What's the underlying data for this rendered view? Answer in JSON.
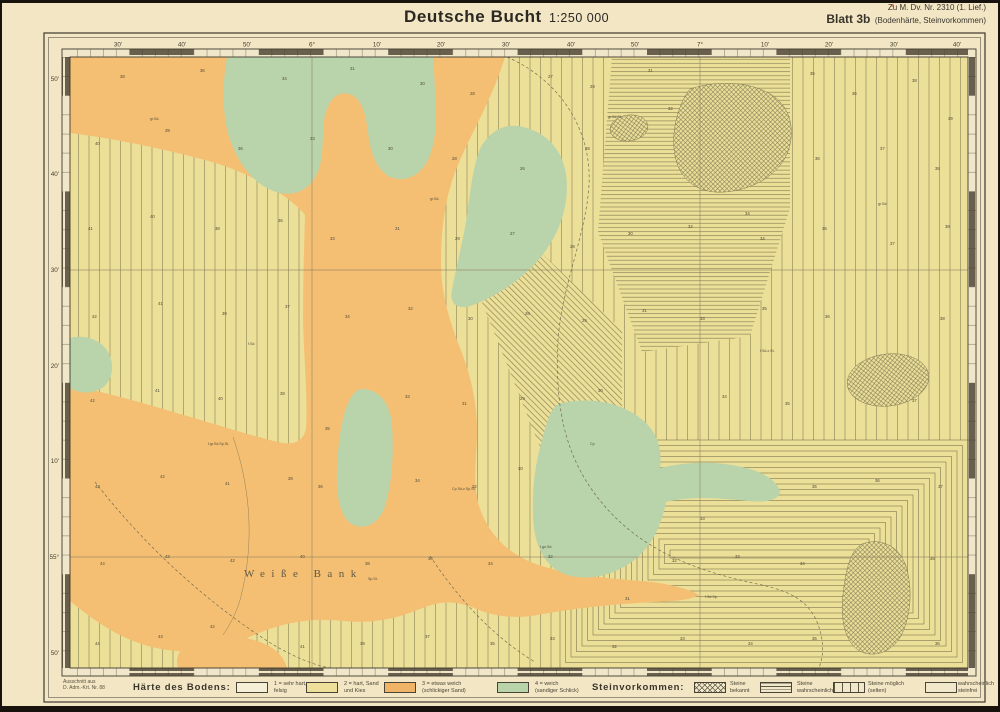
{
  "header": {
    "title": "Deutsche Bucht",
    "scale": "1:250 000",
    "ref_top": "Zu M. Dv. Nr. 2310 (1. Lief.)",
    "sheet": "Blatt 3b",
    "sheet_sub": "(Bodenhärte, Steinvorkommen)"
  },
  "colors": {
    "paper": "#f2e6c5",
    "map_yellow": "#ecdf97",
    "orange": "#f4bf73",
    "green": "#b9d3ab",
    "hatch": "#6e6747",
    "frame": "#3f3a2e",
    "ink": "#2b2822"
  },
  "legend": {
    "source_note_line1": "Ausschnitt aus",
    "source_note_line2": "D. Adm.-Krt. Nr. 88",
    "hardness_title": "Härte des Bodens:",
    "hardness_items": [
      {
        "line1": "1 = sehr hart,",
        "line2": "felsig",
        "swatch": "white"
      },
      {
        "line1": "2 = hart, Sand",
        "line2": "und Kies",
        "swatch": "yellow"
      },
      {
        "line1": "3 = etwas weich",
        "line2": "(schlickiger Sand)",
        "swatch": "orange"
      },
      {
        "line1": "4 = weich",
        "line2": "(sandiger Schlick)",
        "swatch": "green"
      }
    ],
    "stones_title": "Steinvorkommen:",
    "stones_items": [
      {
        "line1": "Steine",
        "line2": "bekannt",
        "swatch": "cross"
      },
      {
        "line1": "Steine",
        "line2": "wahrscheinlich",
        "swatch": "hlines"
      },
      {
        "line1": "Steine möglich",
        "line2": "(selten)",
        "swatch": "vlines"
      },
      {
        "line1": "wahrscheinlich",
        "line2": "steinfrei",
        "swatch": "plain"
      }
    ]
  },
  "map": {
    "sea_label": {
      "text": "Weiße Bank",
      "x": 244,
      "y": 577
    },
    "lon_labels": [
      [
        118,
        "30'"
      ],
      [
        182,
        "40'"
      ],
      [
        247,
        "50'"
      ],
      [
        312,
        "6°"
      ],
      [
        377,
        "10'"
      ],
      [
        441,
        "20'"
      ],
      [
        506,
        "30'"
      ],
      [
        571,
        "40'"
      ],
      [
        635,
        "50'"
      ],
      [
        700,
        "7°"
      ],
      [
        765,
        "10'"
      ],
      [
        829,
        "20'"
      ],
      [
        894,
        "30'"
      ],
      [
        957,
        "40'"
      ]
    ],
    "lat_labels": [
      [
        79,
        "50'"
      ],
      [
        174,
        "40'"
      ],
      [
        270,
        "30'"
      ],
      [
        366,
        "20'"
      ],
      [
        461,
        "10'"
      ],
      [
        557,
        "55°"
      ],
      [
        653,
        "50'"
      ]
    ],
    "graticule": {
      "v": [
        312,
        700
      ],
      "h": [
        270,
        557
      ]
    },
    "zones": [
      {
        "kind": "vlines",
        "rect": [
          70,
          57,
          545,
          611
        ]
      },
      {
        "kind": "vlines",
        "rect": [
          615,
          57,
          353,
          388
        ]
      },
      {
        "kind": "hlines",
        "path": "M612,57 L790,57 L790,208 L750,336 L642,352 L598,232 Z"
      },
      {
        "kind": "diag",
        "path": "M482,196 L622,330 L622,448 L546,462 L482,302 Z"
      },
      {
        "kind": "rings",
        "rect": [
          560,
          440,
          408,
          228
        ],
        "inset": 5.5
      }
    ],
    "soil_regions": [
      {
        "fill": "orange",
        "d": "M70,57 L505,57 C492,100 470,135 458,165 C445,195 441,230 441,262 C441,295 450,322 460,348 C472,378 477,405 477,432 C477,458 472,480 479,506 C488,534 508,553 533,563 C562,574 602,578 641,581 C668,583 689,589 699,595 C688,601 672,601 655,602 C615,604 575,608 543,614 C515,620 492,616 474,608 C452,599 438,602 420,609 C396,619 370,624 344,621 C316,618 290,621 264,631 C243,640 218,649 194,651 C168,653 140,646 116,633 C98,623 82,611 70,601 L70,385 C100,391 140,402 180,414 C215,424 252,436 278,442 C294,446 304,441 306,428 C308,400 304,360 303,320 C303,285 304,250 305,215 C290,196 250,172 205,160 C160,148 110,138 70,133 Z"
      },
      {
        "fill": "orange",
        "d": "M178,668 C174,656 182,644 198,639 C221,633 249,636 267,645 C279,651 285,660 287,668 Z"
      },
      {
        "fill": "green",
        "d": "M227,57 L433,57 C434,70 435,85 435,98 C437,120 436,143 428,160 C420,176 404,184 388,176 C376,168 370,152 368,132 C366,115 362,100 352,95 C340,90 330,96 325,115 C322,130 324,148 320,165 C315,185 300,197 280,193 C258,188 240,168 230,140 C222,115 222,85 227,57 Z"
      },
      {
        "fill": "green",
        "d": "M518,126 C544,130 562,148 566,174 C570,204 560,234 540,258 C522,279 498,296 470,306 C457,310 449,303 452,290 C456,268 462,245 466,222 C470,195 472,170 480,149 C488,133 502,124 518,126 Z"
      },
      {
        "fill": "green",
        "d": "M70,338 C85,334 101,340 108,352 C115,365 113,380 102,388 C90,395 78,393 70,388 Z"
      },
      {
        "fill": "green",
        "d": "M362,389 C378,389 390,402 392,425 C394,455 392,486 384,509 C377,526 362,531 350,523 C340,515 336,496 337,470 C338,442 342,414 350,399 C354,392 358,389 362,389 Z"
      },
      {
        "fill": "green",
        "d": "M558,404 C588,396 620,402 640,418 C656,430 663,448 660,468 C684,462 716,460 746,468 C766,473 779,483 780,492 C779,500 765,503 748,501 C720,498 690,496 666,502 C662,522 654,542 639,556 C620,573 594,581 571,576 C549,571 537,552 534,528 C531,500 534,468 541,444 C546,424 550,410 558,404 Z"
      }
    ],
    "stone_regions": [
      {
        "d": "M690,89 C720,79 756,82 776,98 C792,111 796,135 786,156 C776,176 752,190 725,192 C700,194 682,182 676,160 C670,138 676,107 690,89 Z"
      },
      {
        "ellipse": [
          629,
          128,
          19,
          13,
          -8
        ]
      },
      {
        "ellipse": [
          888,
          380,
          41,
          26,
          -7
        ]
      },
      {
        "d": "M862,544 C881,537 899,546 906,566 C913,589 911,616 901,636 C891,653 872,659 858,650 C845,641 840,619 843,594 C846,569 850,551 862,544 Z"
      }
    ],
    "dashed_lines": [
      "M507,57 C560,80 592,130 589,185 C586,235 562,285 558,340 C555,400 562,452 598,498 C640,552 700,572 762,585 C792,592 816,602 822,640 C824,653 821,662 819,668",
      "M95,482 C140,540 200,598 272,644 C296,658 316,666 331,668",
      "M430,556 C458,598 492,636 535,662"
    ],
    "contour_lines": [
      "M233,437 C252,492 254,548 240,600 C236,614 229,626 223,635"
    ],
    "soundings": [
      [
        120,
        78,
        "38"
      ],
      [
        200,
        72,
        "36"
      ],
      [
        282,
        80,
        "34"
      ],
      [
        350,
        70,
        "31"
      ],
      [
        420,
        85,
        "30"
      ],
      [
        470,
        95,
        "28"
      ],
      [
        548,
        78,
        "27"
      ],
      [
        590,
        88,
        "29"
      ],
      [
        648,
        72,
        "31"
      ],
      [
        668,
        110,
        "32"
      ],
      [
        810,
        75,
        "35"
      ],
      [
        852,
        95,
        "36"
      ],
      [
        912,
        82,
        "38"
      ],
      [
        948,
        120,
        "39"
      ],
      [
        95,
        145,
        "40"
      ],
      [
        165,
        132,
        "39"
      ],
      [
        238,
        150,
        "36"
      ],
      [
        310,
        140,
        "33"
      ],
      [
        388,
        150,
        "30"
      ],
      [
        452,
        160,
        "28"
      ],
      [
        520,
        170,
        "26"
      ],
      [
        585,
        150,
        "28"
      ],
      [
        745,
        215,
        "34"
      ],
      [
        815,
        160,
        "36"
      ],
      [
        880,
        150,
        "37"
      ],
      [
        935,
        170,
        "38"
      ],
      [
        88,
        230,
        "41"
      ],
      [
        150,
        218,
        "40"
      ],
      [
        215,
        230,
        "38"
      ],
      [
        278,
        222,
        "36"
      ],
      [
        330,
        240,
        "33"
      ],
      [
        395,
        230,
        "31"
      ],
      [
        455,
        240,
        "29"
      ],
      [
        510,
        235,
        "27"
      ],
      [
        570,
        248,
        "28"
      ],
      [
        628,
        235,
        "30"
      ],
      [
        688,
        228,
        "32"
      ],
      [
        760,
        240,
        "34"
      ],
      [
        822,
        230,
        "36"
      ],
      [
        890,
        245,
        "37"
      ],
      [
        945,
        228,
        "38"
      ],
      [
        92,
        318,
        "42"
      ],
      [
        158,
        305,
        "41"
      ],
      [
        222,
        315,
        "39"
      ],
      [
        285,
        308,
        "37"
      ],
      [
        345,
        318,
        "34"
      ],
      [
        408,
        310,
        "32"
      ],
      [
        468,
        320,
        "30"
      ],
      [
        525,
        315,
        "28"
      ],
      [
        582,
        322,
        "29"
      ],
      [
        642,
        312,
        "31"
      ],
      [
        700,
        320,
        "33"
      ],
      [
        762,
        310,
        "35"
      ],
      [
        825,
        318,
        "36"
      ],
      [
        940,
        320,
        "38"
      ],
      [
        90,
        402,
        "42"
      ],
      [
        155,
        392,
        "41"
      ],
      [
        218,
        400,
        "40"
      ],
      [
        280,
        395,
        "38"
      ],
      [
        325,
        430,
        "35"
      ],
      [
        405,
        398,
        "33"
      ],
      [
        462,
        405,
        "31"
      ],
      [
        520,
        400,
        "29"
      ],
      [
        598,
        392,
        "30"
      ],
      [
        722,
        398,
        "34"
      ],
      [
        785,
        405,
        "35"
      ],
      [
        912,
        402,
        "37"
      ],
      [
        95,
        488,
        "43"
      ],
      [
        160,
        478,
        "42"
      ],
      [
        225,
        485,
        "41"
      ],
      [
        288,
        480,
        "39"
      ],
      [
        318,
        488,
        "36"
      ],
      [
        415,
        482,
        "34"
      ],
      [
        472,
        488,
        "32"
      ],
      [
        518,
        470,
        "30"
      ],
      [
        700,
        520,
        "33"
      ],
      [
        812,
        488,
        "35"
      ],
      [
        875,
        482,
        "36"
      ],
      [
        938,
        488,
        "37"
      ],
      [
        100,
        565,
        "44"
      ],
      [
        165,
        558,
        "43"
      ],
      [
        230,
        562,
        "42"
      ],
      [
        300,
        558,
        "40"
      ],
      [
        365,
        565,
        "38"
      ],
      [
        428,
        560,
        "36"
      ],
      [
        488,
        565,
        "34"
      ],
      [
        548,
        558,
        "32"
      ],
      [
        625,
        600,
        "31"
      ],
      [
        672,
        562,
        "32"
      ],
      [
        735,
        558,
        "33"
      ],
      [
        800,
        565,
        "34"
      ],
      [
        930,
        560,
        "36"
      ],
      [
        95,
        645,
        "44"
      ],
      [
        158,
        638,
        "43"
      ],
      [
        210,
        628,
        "42"
      ],
      [
        300,
        648,
        "41"
      ],
      [
        360,
        645,
        "39"
      ],
      [
        425,
        638,
        "37"
      ],
      [
        490,
        645,
        "35"
      ],
      [
        550,
        640,
        "33"
      ],
      [
        612,
        648,
        "32"
      ],
      [
        680,
        640,
        "33"
      ],
      [
        748,
        645,
        "34"
      ],
      [
        812,
        640,
        "35"
      ],
      [
        935,
        645,
        "36"
      ]
    ],
    "notes": [
      [
        248,
        345,
        "f.Sd."
      ],
      [
        430,
        200,
        "gr.Sd."
      ],
      [
        208,
        445,
        "f.gr.Sd.Sp.St."
      ],
      [
        452,
        490,
        "Cp.Sd.z.Sp.St."
      ],
      [
        368,
        580,
        "Sp.St."
      ],
      [
        608,
        118,
        "gr.Sd.St."
      ],
      [
        760,
        352,
        "f.Sd.z.St."
      ],
      [
        540,
        548,
        "f.gn.Sd."
      ],
      [
        878,
        205,
        "gr.Sd."
      ],
      [
        705,
        598,
        "f.Sd.Sp."
      ],
      [
        150,
        120,
        "gr.Sd."
      ],
      [
        590,
        445,
        "Cp"
      ]
    ]
  }
}
